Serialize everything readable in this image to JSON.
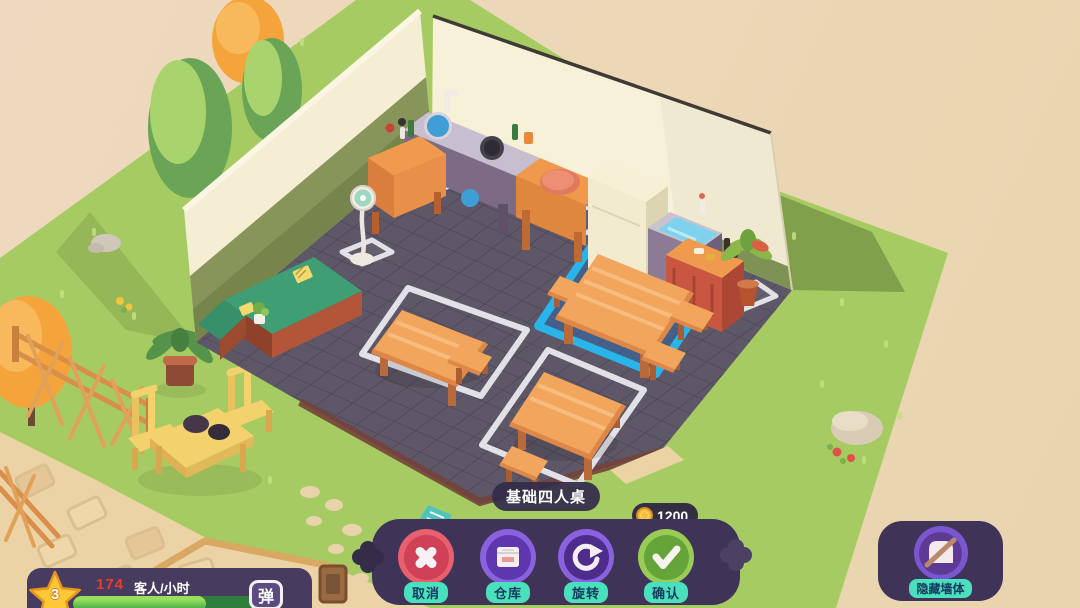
{
  "hud": {
    "selection_tooltip": "基础四人桌",
    "price": {
      "icon": "gold-coin-icon",
      "amount": "1200"
    },
    "toolbar": {
      "buttons": [
        {
          "id": "cancel",
          "label": "取消",
          "icon": "x-icon"
        },
        {
          "id": "warehouse",
          "label": "仓库",
          "icon": "storage-box-icon"
        },
        {
          "id": "rotate",
          "label": "旋转",
          "icon": "rotate-arrow-icon"
        },
        {
          "id": "confirm",
          "label": "确认",
          "icon": "check-icon"
        }
      ]
    },
    "hide_walls_button": {
      "label": "隐藏墙体",
      "icon": "hidden-wall-icon"
    },
    "stats_panel": {
      "star_level": "3",
      "rate_value": "174",
      "rate_unit": "客人/小时",
      "progress_percent": 70,
      "side_button_label": "弹"
    }
  },
  "colors": {
    "background_beige": "#ecd8b8",
    "grass_green": "#a6cb62",
    "floor_slate": "#5e5767",
    "wall_cream": "#f8f1d9",
    "wood_orange": "#f2a55c",
    "selection_blue": "#2ab5ea",
    "placement_outline_white": "#e3e1e8",
    "panel_purple": "#3f3457",
    "label_teal": "#4be0bd",
    "label_text_navy": "#14395f",
    "cancel_red": "#d04057",
    "button_purple": "#5e36ae",
    "confirm_green": "#64a438",
    "coin_gold": "#f6bd3e",
    "rate_red": "#ee3a28"
  }
}
